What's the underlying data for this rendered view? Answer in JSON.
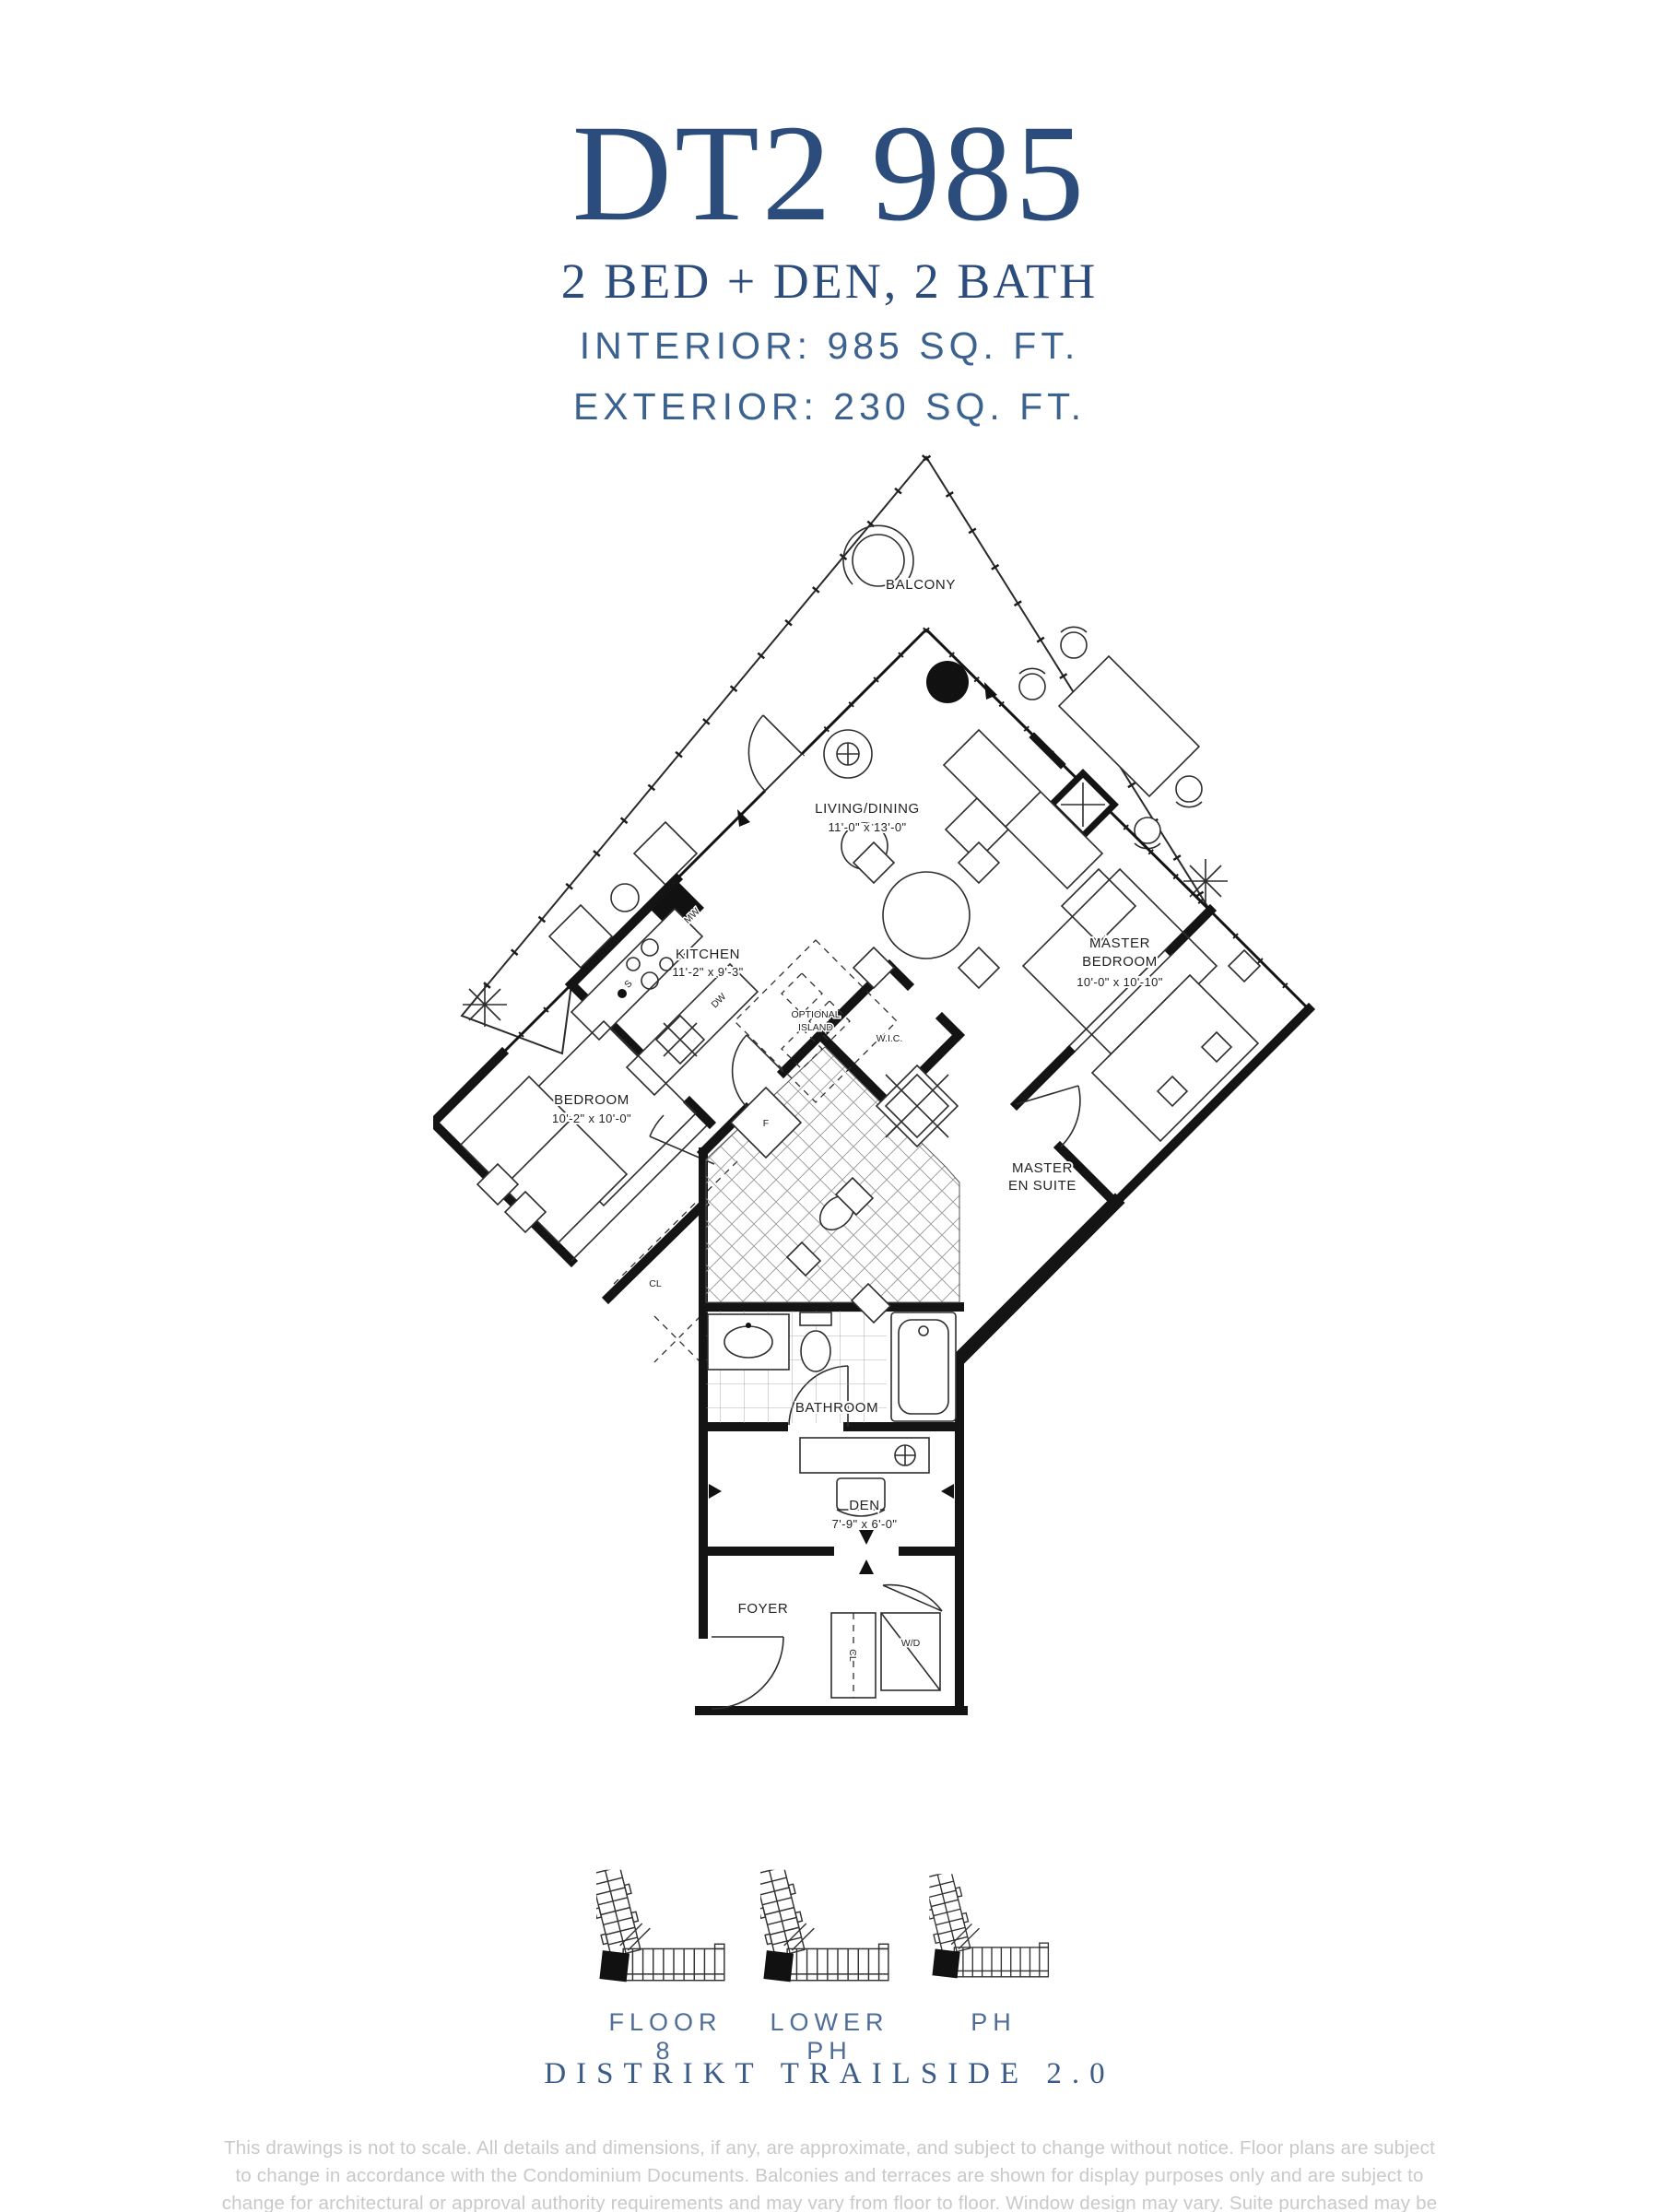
{
  "header": {
    "unit_code": "DT2 985",
    "configuration": "2 BED + DEN, 2 BATH",
    "interior_area": "INTERIOR: 985 SQ. FT.",
    "exterior_area": "EXTERIOR: 230 SQ. FT."
  },
  "plan": {
    "rooms": {
      "balcony": {
        "name": "BALCONY"
      },
      "living": {
        "name": "LIVING/DINING",
        "dims": "11'-0\" x 13'-0\""
      },
      "kitchen": {
        "name": "KITCHEN",
        "dims": "11'-2\" x 9'-3\""
      },
      "island": {
        "line1": "OPTIONAL",
        "line2": "ISLAND"
      },
      "master": {
        "line1": "MASTER",
        "line2": "BEDROOM",
        "dims": "10'-0\" x 10'-10\""
      },
      "bedroom": {
        "name": "BEDROOM",
        "dims": "10'-2\" x 10'-0\""
      },
      "wic": {
        "name": "W.I.C."
      },
      "ensuite": {
        "line1": "MASTER",
        "line2": "EN SUITE"
      },
      "bathroom": {
        "name": "BATHROOM"
      },
      "den": {
        "name": "DEN",
        "dims": "7'-9\" x 6'-0\""
      },
      "foyer": {
        "name": "FOYER"
      }
    },
    "labels": {
      "microwave": "MW",
      "sink": "S",
      "dishwasher": "DW",
      "fridge": "F",
      "closet": "CL",
      "washer_dryer": "W/D"
    }
  },
  "keyplans": {
    "items": [
      {
        "label": "FLOOR 8"
      },
      {
        "label": "LOWER PH"
      },
      {
        "label": "PH"
      }
    ]
  },
  "footer": {
    "project": "DISTRIKT TRAILSIDE 2.0",
    "disclaimer": "This drawings is not to scale. All details and dimensions, if any, are approximate, and subject to change without notice. Floor plans are subject to change in accordance with the Condominium Documents. Balconies and terraces are shown for display purposes only and are subject to change for architectural or approval authority requirements and may vary from floor to floor. Window design may vary. Suite purchased may be mirror image of layout shown. All furniture is for illustration purposes only. Flooring patterns may vary. E. & O.E."
  },
  "colors": {
    "brand_blue": "#2c4c7c",
    "label_blue": "#4e6d99",
    "plan_ink": "#141414",
    "disclaimer_gray": "#c9c9c9"
  }
}
